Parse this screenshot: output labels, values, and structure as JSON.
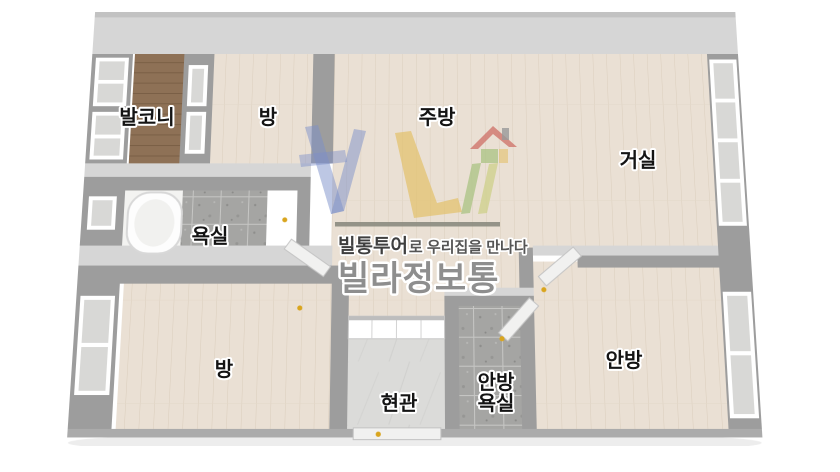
{
  "page": {
    "type": "floorplan-3d-dollhouse-view",
    "background": "#ffffff"
  },
  "rooms": {
    "balcony": {
      "label": "발코니"
    },
    "bedroom_top": {
      "label": "방"
    },
    "kitchen": {
      "label": "주방"
    },
    "living_room": {
      "label": "거실"
    },
    "bathroom": {
      "label": "욕실"
    },
    "bedroom_left": {
      "label": "방"
    },
    "entrance": {
      "label": "현관"
    },
    "master_bathroom": {
      "label_line1": "안방",
      "label_line2": "욕실"
    },
    "master_bedroom": {
      "label": "안방"
    }
  },
  "watermark": {
    "slogan_bold": "빌통투어",
    "slogan_rest": "로 우리집을 만나다",
    "brand": "빌라정보통"
  },
  "palette": {
    "wall": "#9d9d9d",
    "wall_top_face": "#d6d6d6",
    "wood_floor": "#eae0d4",
    "balcony_floor": "#8e7156",
    "tile_floor": "#a5a5a3",
    "marble_floor": "#dbdbd9",
    "door_handle_gold": "#d9a51e",
    "divider": "#8b8b80",
    "logo_blue": "#7c8fca",
    "logo_yellow": "#e3c06a",
    "logo_green": "#a9c383",
    "logo_leg_yellow": "#cdd089",
    "logo_red": "#d0756b",
    "logo_chimney": "#999999",
    "brand_text": "#8e8e8e",
    "slogan_text": "#3f3f3f"
  }
}
